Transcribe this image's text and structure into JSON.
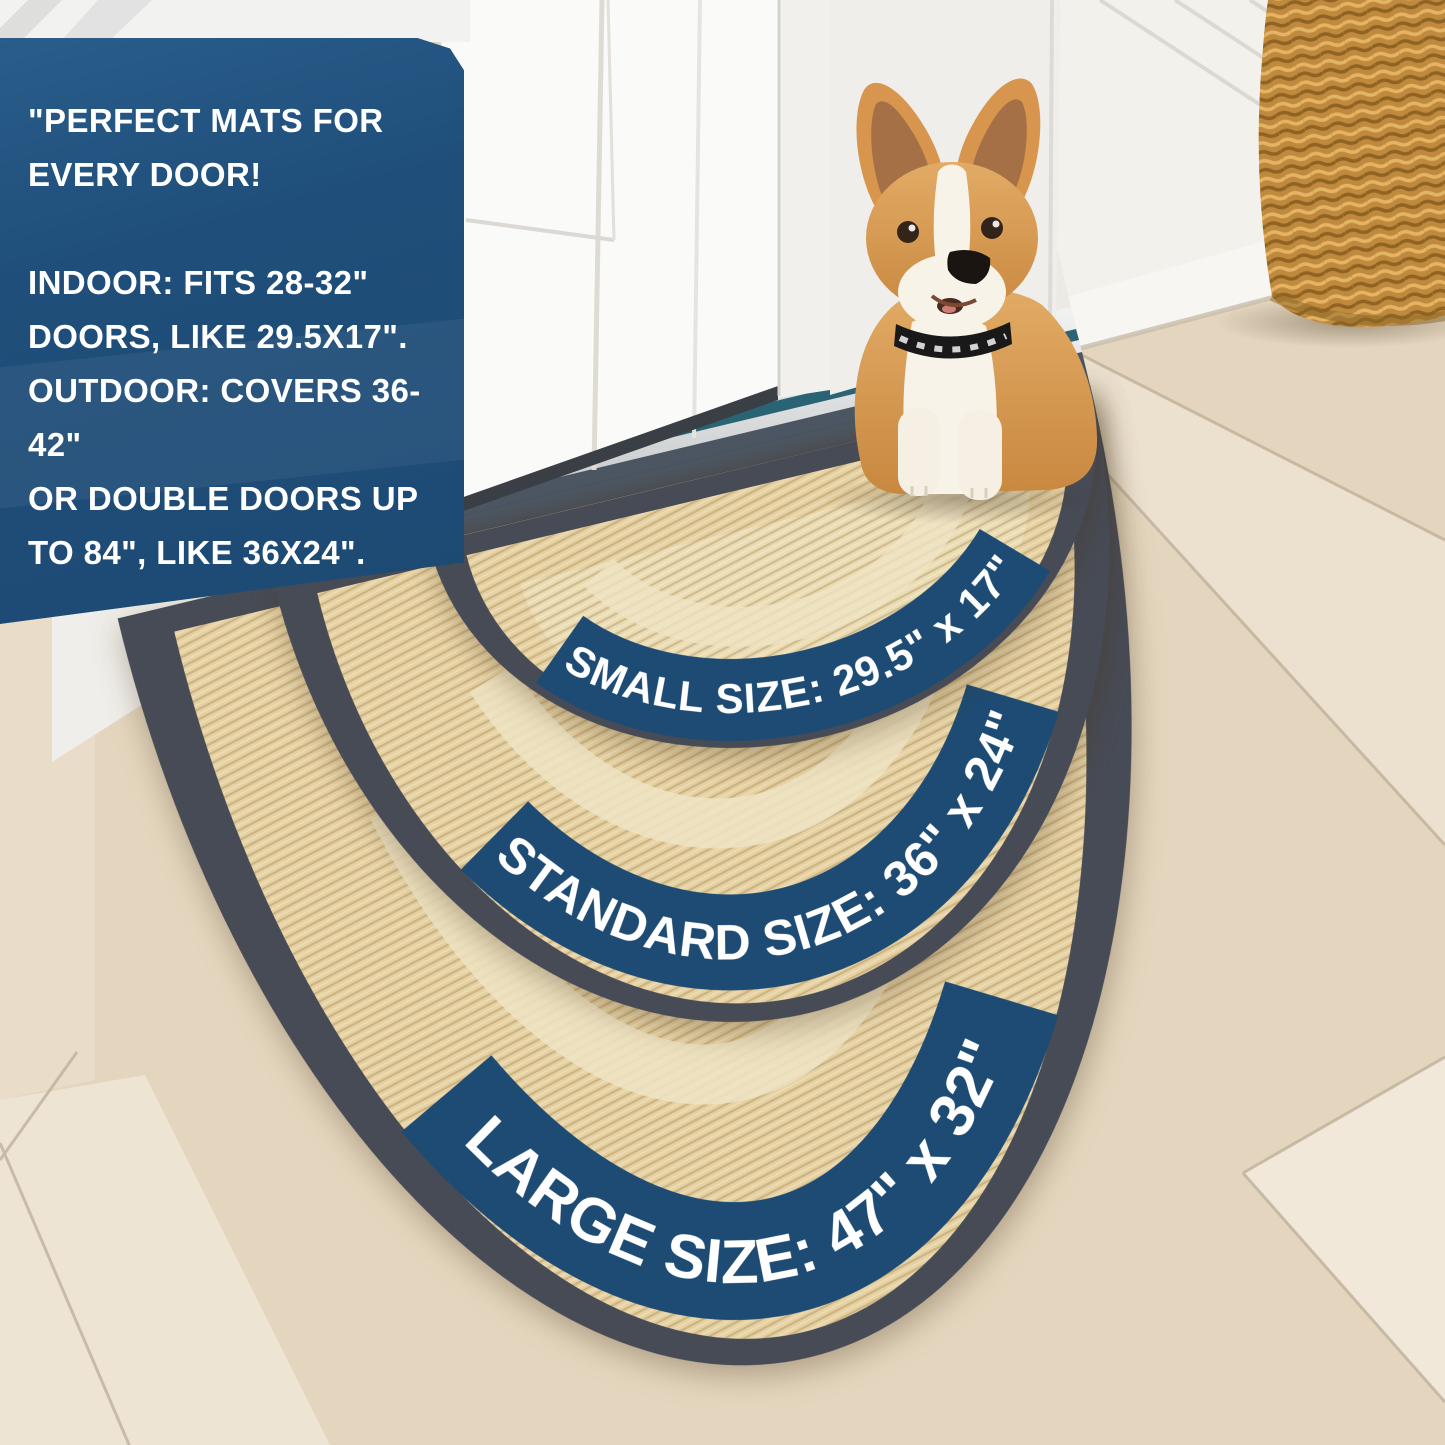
{
  "info_box": {
    "text": "\"PERFECT MATS FOR\nEVERY DOOR!\n\nINDOOR: FITS 28-32\"\nDOORS, LIKE 29.5X17\".\nOUTDOOR: COVERS 36-42\"\nOR DOUBLE DOORS UP\nTO 84\", LIKE 36X24\".\n\nSTYLE MEETS FUNCTION!\""
  },
  "size_labels": {
    "small": "SMALL SIZE: 29.5\" x 17\"",
    "standard": "STANDARD SIZE: 36\" x 24\"",
    "large": "LARGE SIZE: 47\" x 32\""
  },
  "colors": {
    "info_box_blue": "#1f4e7a",
    "label_band_blue": "#1d4b74",
    "label_text": "#ffffff",
    "mat_surface": "#e6d1a2",
    "mat_border": "#474b55",
    "mat_inner_band": "#efe4c4",
    "floor": "#e4d6be",
    "threshold_teal": "#2a6373",
    "basket": "#c08a3e",
    "dog_fur": "#d9974f"
  }
}
